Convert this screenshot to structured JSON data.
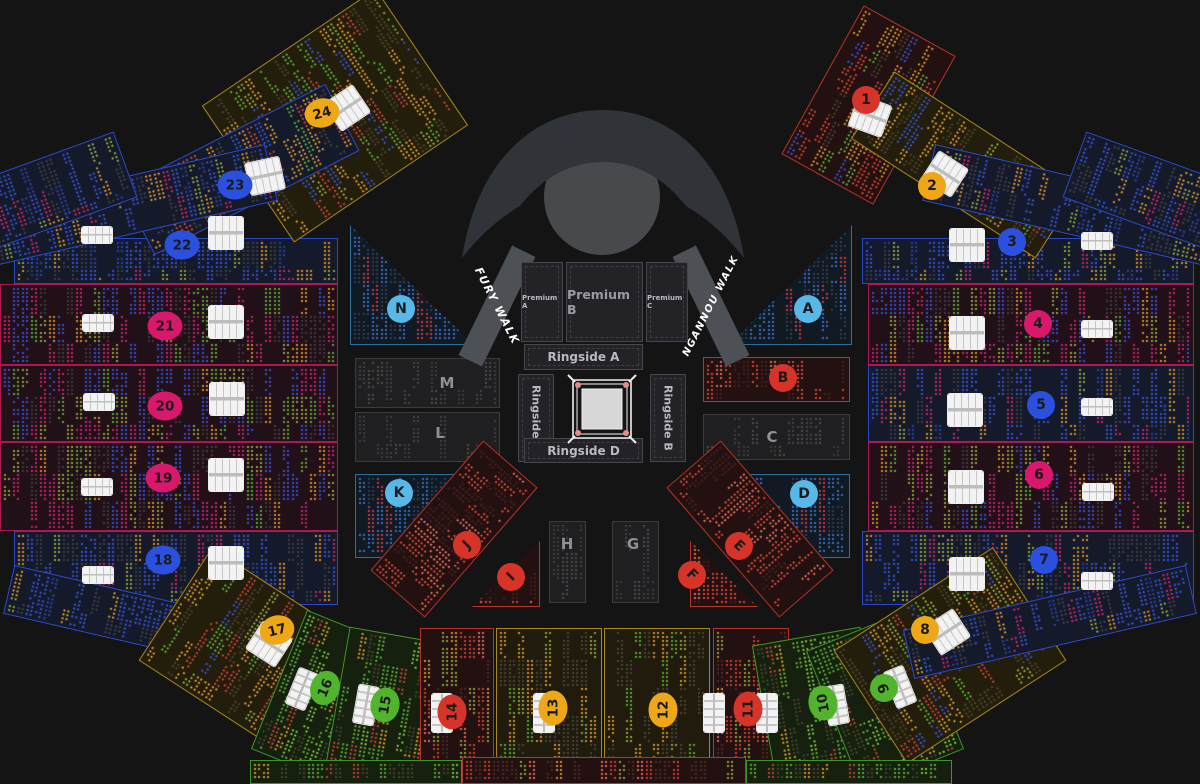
{
  "venue": {
    "walks": {
      "fury": "FURY WALK",
      "ngannou": "NGANNOU WALK"
    },
    "premium": {
      "a": "Premium A",
      "b": "Premium B",
      "c": "Premium C"
    },
    "ringside": {
      "a": "Ringside A",
      "b": "Ringside B",
      "c": "Ringside C",
      "d": "Ringside D"
    },
    "colors": {
      "blue": "#2b50e0",
      "pink": "#d8186a",
      "yellow": "#eea817",
      "green": "#52b42c",
      "red": "#d63429",
      "cyan": "#58b8e8",
      "oblue": "#2b48c8",
      "ocrim": "#aa1850",
      "oyellow": "#a8881c",
      "ogreen": "#3f9428",
      "ored": "#b63429",
      "ocyan": "#2e6f99",
      "ogray": "#3c3c3c"
    },
    "sections": {
      "n1": {
        "label": "1"
      },
      "n2": {
        "label": "2"
      },
      "n3": {
        "label": "3"
      },
      "n4": {
        "label": "4"
      },
      "n5": {
        "label": "5"
      },
      "n6": {
        "label": "6"
      },
      "n7": {
        "label": "7"
      },
      "n8": {
        "label": "8"
      },
      "n9": {
        "label": "9"
      },
      "n10": {
        "label": "10"
      },
      "n11": {
        "label": "11"
      },
      "n12": {
        "label": "12"
      },
      "n13": {
        "label": "13"
      },
      "n14": {
        "label": "14"
      },
      "n15": {
        "label": "15"
      },
      "n16": {
        "label": "16"
      },
      "n17": {
        "label": "17"
      },
      "n18": {
        "label": "18"
      },
      "n19": {
        "label": "19"
      },
      "n20": {
        "label": "20"
      },
      "n21": {
        "label": "21"
      },
      "n22": {
        "label": "22"
      },
      "n23": {
        "label": "23"
      },
      "n24": {
        "label": "24"
      },
      "a": {
        "label": "A"
      },
      "b": {
        "label": "B"
      },
      "c": {
        "label": "C"
      },
      "d": {
        "label": "D"
      },
      "e": {
        "label": "E"
      },
      "f": {
        "label": "F"
      },
      "g": {
        "label": "G"
      },
      "h": {
        "label": "H"
      },
      "i": {
        "label": "I"
      },
      "j": {
        "label": "J"
      },
      "k": {
        "label": "K"
      },
      "l": {
        "label": "L"
      },
      "m": {
        "label": "M"
      },
      "n": {
        "label": "N"
      }
    },
    "palettes": {
      "bandBlue": [
        "#3550cf",
        "#3550cf",
        "#2a3f9e",
        "#3e3e42",
        "#3e3e42",
        "#c2266a",
        "#d2902a",
        "#8fa23b",
        "",
        "#3550cf"
      ],
      "bandCrim": [
        "#3550cf",
        "#c2266a",
        "#3e3a3e",
        "#3e3a3e",
        "#3550cf",
        "#d2902a",
        "#8fa23b",
        "#58a832",
        "",
        "#c2266a"
      ],
      "fanYellow": [
        "#d2952c",
        "#d2952c",
        "#4a4228",
        "#8fa23b",
        "#58a832",
        "#3550cf",
        "#c24034",
        "#4a4228",
        ""
      ],
      "fanGreen": [
        "#58a832",
        "#7bc143",
        "#d2952c",
        "#c24034",
        "#43432b",
        "#43432b",
        "",
        "#58a832"
      ],
      "fanRed": [
        "#c8422e",
        "#d2952c",
        "#4a2c22",
        "#c8422e",
        "#8fa23b",
        "#4a2c22",
        "",
        "#e0685c"
      ],
      "fanMix": [
        "#d2952c",
        "#58a832",
        "#3550cf",
        "#c8422e",
        "#c8422e",
        "#454036",
        "",
        "#d2902a"
      ],
      "bottomYellow": [
        "#d2952c",
        "#4a4433",
        "#4a4433",
        "#8fa23b",
        "#58a832",
        "#4a4433",
        "",
        "#d2952c",
        ""
      ],
      "triCyan": [
        "#3a6fc0",
        "#3a6fc0",
        "#2f3f52",
        "#c23a4a",
        "#2f3f52",
        "#2f3f52",
        "",
        "#3a6fc0"
      ],
      "parRed": [
        "#cf4936",
        "#e06a5a",
        "#44211c",
        "#44211c",
        "#cf4936",
        "",
        "#cf4936"
      ],
      "boxGray": [
        "#4c4c4e",
        "#434345",
        "",
        "#3d3d3f",
        "",
        ""
      ],
      "boxRed": [
        "#cf4936",
        "#e06a5a",
        "#45201c",
        "",
        "#cf4936",
        ""
      ]
    }
  }
}
